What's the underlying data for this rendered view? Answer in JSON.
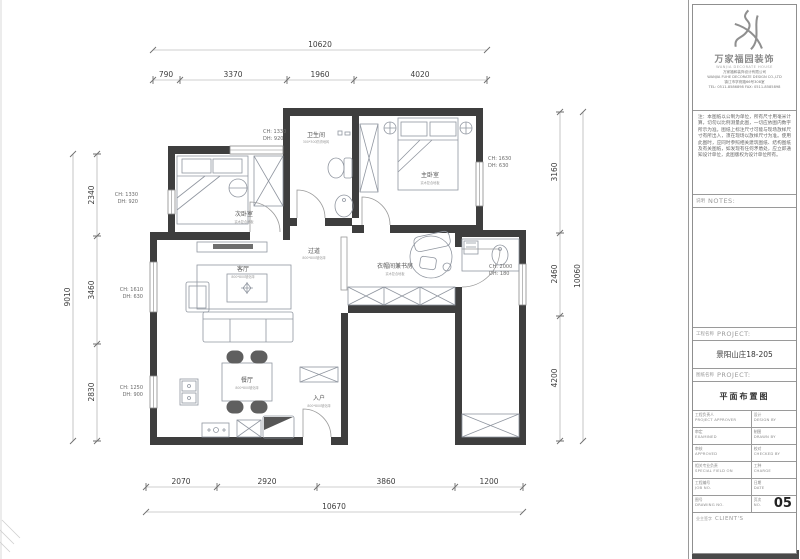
{
  "dims": {
    "top": {
      "total": "10620",
      "segments": [
        "790",
        "3370",
        "1960",
        "4020"
      ]
    },
    "bottom": {
      "total": "10670",
      "segments": [
        "2070",
        "2920",
        "3860",
        "1200"
      ]
    },
    "left": {
      "total": "9010",
      "segments": [
        "2340",
        "3460",
        "2830"
      ]
    },
    "right": {
      "total": "10060",
      "segments": [
        "3160",
        "2460",
        "4200"
      ]
    }
  },
  "rooms": [
    {
      "name": "次卧室",
      "finish": "实木复合地板"
    },
    {
      "name": "卫生间",
      "finish": "300*300防滑地砖"
    },
    {
      "name": "主卧室",
      "finish": "实木复合地板"
    },
    {
      "name": "过道",
      "finish": "800*800玻化砖"
    },
    {
      "name": "衣帽间兼书房",
      "finish": "实木复合地板"
    },
    {
      "name": "客厅",
      "finish": "800*800玻化砖"
    },
    {
      "name": "餐厅",
      "finish": "800*800玻化砖"
    },
    {
      "name": "入户",
      "finish": "800*800玻化砖"
    }
  ],
  "windows": [
    {
      "ch": "CH: 1330",
      "dh": "DH: 920"
    },
    {
      "ch": "CH: 1330",
      "dh": "DH: 920"
    },
    {
      "ch": "CH: 1610",
      "dh": "DH: 630"
    },
    {
      "ch": "CH: 1250",
      "dh": "DH: 900"
    },
    {
      "ch": "CH: 1630",
      "dh": "DH: 630"
    },
    {
      "ch": "CH: 2000",
      "dh": "DH: 180"
    }
  ],
  "titleblock": {
    "brand": "万家福园装饰",
    "brand_sub": "WANJIA DECORATE HOUSE",
    "company_line1": "万家福和装饰设计有限公司",
    "company_line2": "WANJIA FUHE DECORATE DESIGN CO.,LTD",
    "company_line3": "镇江市学府路66号308室",
    "company_line4": "TEL: 0511-8586898  FAX: 0511-8585898",
    "note": "注：本图纸以公制为单位，所有尺寸用毫米计算，切勿以比例测量此图，一切应依图内数字所示为准。图纸上标注尺寸可能与现场放样尺寸有所出入，须在现场以放样尺寸为准。使用此图时，应同时参照相关建筑图纸、结构图纸及有关图纸，如发现有任何矛盾处，应立即通知设计单位，此图版权为设计单位所有。",
    "notes_cn": "说明",
    "notes_en": "NOTES:",
    "project_cn": "工程名称",
    "project_en": "PROJECT:",
    "project_value": "景阳山庄18-205",
    "drawing_cn": "图纸名称",
    "drawing_en": "PROJECT:",
    "drawing_value": "平面布置图",
    "table": {
      "rows": [
        {
          "l_cn": "工程负责人",
          "l_en": "PROJECT APPROVER",
          "r_cn": "设计",
          "r_en": "DESIGN BY"
        },
        {
          "l_cn": "审定",
          "l_en": "EXAMINED",
          "r_cn": "制图",
          "r_en": "DRAWN BY"
        },
        {
          "l_cn": "审核",
          "l_en": "APPROVED",
          "r_cn": "校对",
          "r_en": "CHECKED BY"
        },
        {
          "l_cn": "相关专业负责",
          "l_en": "SPECIAL FIELD ON",
          "r_cn": "工种",
          "r_en": "CHARGE"
        },
        {
          "l_cn": "工程编号",
          "l_en": "JOB NO.",
          "r_cn": "日期",
          "r_en": "DATE"
        },
        {
          "l_cn": "图号",
          "l_en": "DRAWING NO.",
          "r_cn": "页次",
          "r_en": "NO."
        }
      ]
    },
    "page_number": "05",
    "client_cn": "业主签字",
    "client_en": "CLIENT'S"
  }
}
